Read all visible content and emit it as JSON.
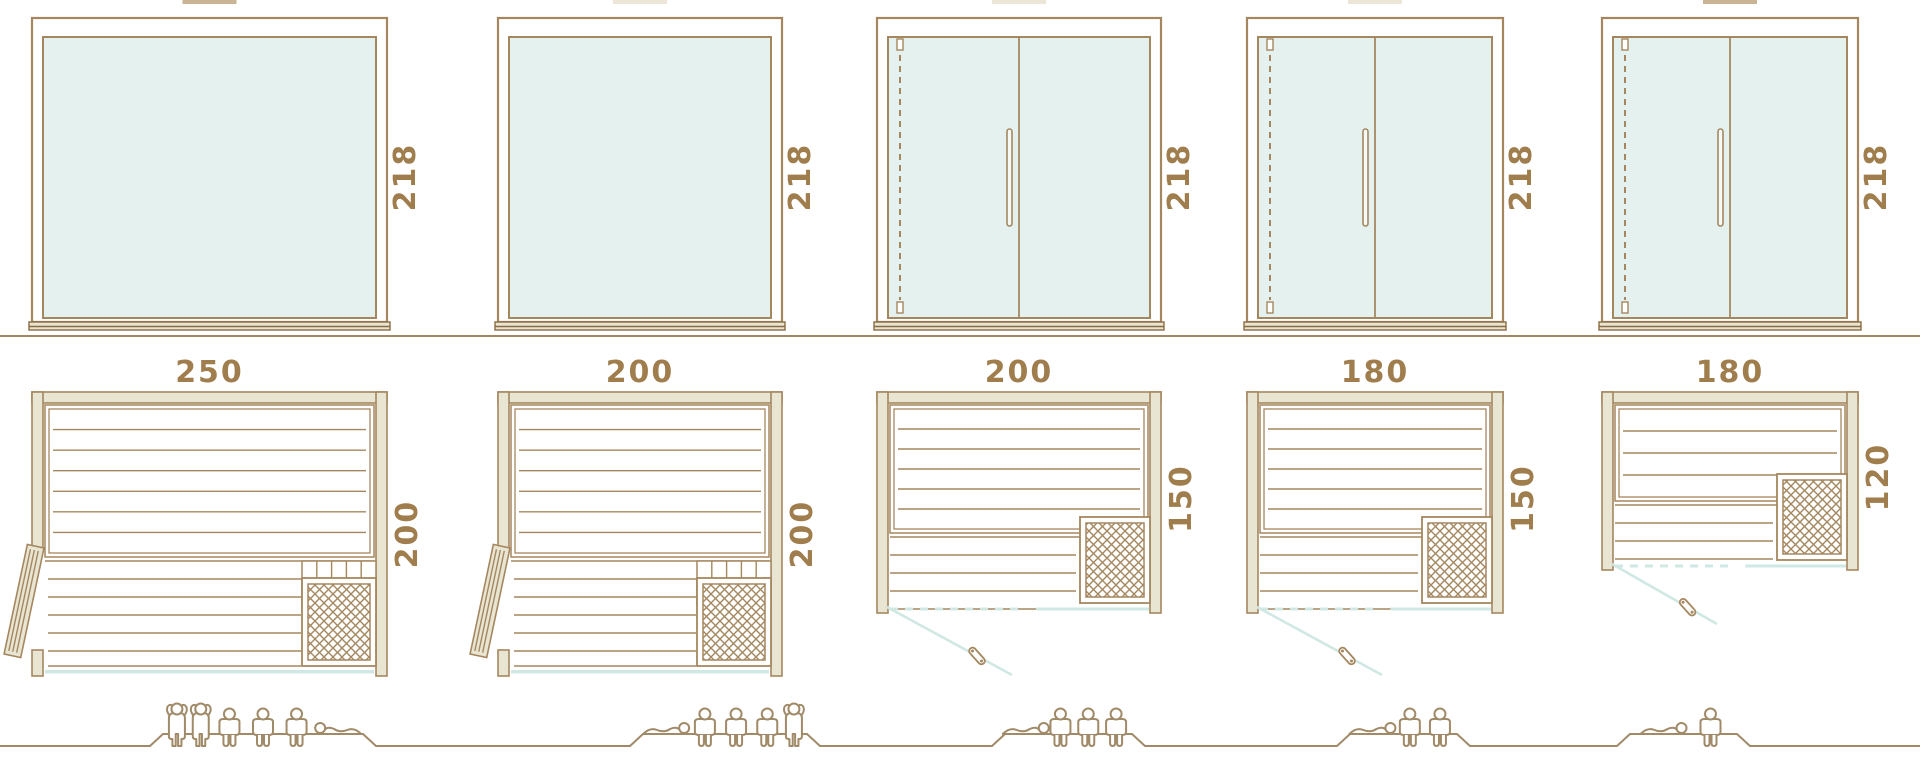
{
  "diagram": {
    "kind": "sauna-cabin-size-diagram",
    "rows": [
      "front-elevations",
      "floor-plans",
      "capacity-figures"
    ]
  },
  "colors": {
    "line": "#a5875f",
    "line_dark": "#8a6b43",
    "dim_text": "#a07d4c",
    "glass": "#e4f1ee",
    "wall_fill": "#e8e5d3",
    "teal_accent": "#cfe8e3",
    "people_line": "#a18a68",
    "white": "#ffffff",
    "crop_mark_tan": "#c9b494",
    "crop_mark_light": "#ece6d8"
  },
  "units": [
    {
      "name": "cabin-250x200",
      "width_cm": 250,
      "depth_cm": 200,
      "height_cm": 218,
      "front_type": "fixed-glass-panel",
      "plan_features": [
        "hinged-wood-door-left",
        "upper-bench",
        "lower-bench",
        "slat-bench-right",
        "heater-bottom-right",
        "glass-front"
      ],
      "capacity": {
        "total": 6,
        "standing": 2,
        "sitting": 3,
        "lying": 1,
        "order": [
          "standing",
          "standing",
          "sitting",
          "sitting",
          "sitting",
          "lying-left"
        ]
      },
      "top_crop_mark": "tan"
    },
    {
      "name": "cabin-200x200",
      "width_cm": 200,
      "depth_cm": 200,
      "height_cm": 218,
      "front_type": "fixed-glass-panel",
      "plan_features": [
        "hinged-wood-door-left",
        "upper-bench",
        "lower-bench",
        "slat-bench-right",
        "heater-bottom-right",
        "glass-front"
      ],
      "capacity": {
        "total": 5,
        "standing": 1,
        "sitting": 3,
        "lying": 1,
        "order": [
          "lying-right",
          "sitting",
          "sitting",
          "sitting",
          "standing"
        ]
      },
      "top_crop_mark": "light"
    },
    {
      "name": "cabin-200x150",
      "width_cm": 200,
      "depth_cm": 150,
      "height_cm": 218,
      "front_type": "glass-front-with-hinged-door",
      "plan_features": [
        "glass-front-door-swing",
        "upper-bench",
        "lower-bench",
        "heater-bottom-right"
      ],
      "capacity": {
        "total": 4,
        "standing": 0,
        "sitting": 3,
        "lying": 1,
        "order": [
          "lying-right",
          "sitting",
          "sitting",
          "sitting"
        ]
      },
      "top_crop_mark": "light"
    },
    {
      "name": "cabin-180x150",
      "width_cm": 180,
      "depth_cm": 150,
      "height_cm": 218,
      "front_type": "glass-front-with-hinged-door",
      "plan_features": [
        "glass-front-door-swing",
        "upper-bench",
        "lower-bench",
        "heater-bottom-right"
      ],
      "capacity": {
        "total": 3,
        "standing": 0,
        "sitting": 2,
        "lying": 1,
        "order": [
          "lying-right",
          "sitting",
          "sitting"
        ]
      },
      "top_crop_mark": "light"
    },
    {
      "name": "cabin-180x120",
      "width_cm": 180,
      "depth_cm": 120,
      "height_cm": 218,
      "front_type": "glass-front-with-hinged-door",
      "plan_features": [
        "glass-front-door-swing",
        "upper-bench",
        "lower-bench",
        "heater-bottom-right"
      ],
      "capacity": {
        "total": 2,
        "standing": 0,
        "sitting": 1,
        "lying": 1,
        "order": [
          "lying-right",
          "sitting"
        ]
      },
      "top_crop_mark": "tan"
    }
  ]
}
